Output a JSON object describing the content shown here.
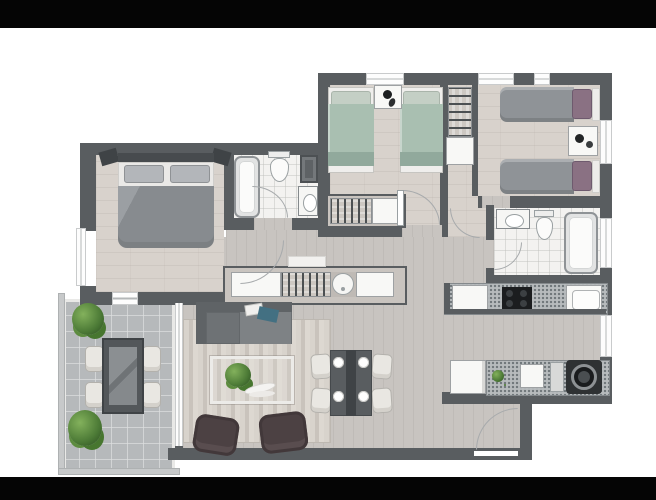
{
  "meta": {
    "description": "Top-down 3D rendered floor plan of a 3-bedroom apartment with two bathrooms, galley kitchen, living-dining room and terrace, shown on a white background with black letterbox bars top and bottom",
    "render_style": "greyscale architectural render"
  },
  "palette": {
    "letterbox": "#050505",
    "wall": "#595d60",
    "floorBed": "#d8d2cc",
    "floorLive": "#c8c4c0",
    "floorBath": "#f3f2f0",
    "floorTerrace": "#b6b9bb",
    "granite": "#b7bbbd",
    "sofa": "#7e8285",
    "chaise": "#6e7275",
    "armchair": "#4c4143",
    "rugA": "#d8d3cc",
    "rugB": "#c9c3bc",
    "bedGreen": "#a9bfb1",
    "bedGreenFold": "#91a99c",
    "pillowGreen": "#c4cfc5",
    "duvetGrey": "#8f9397",
    "pillowPurple": "#8a7183",
    "duvetMaster": "#878b8f",
    "plantDark": "#4c7a36",
    "plantLight": "#83b15c",
    "tableDark": "#595d60",
    "chairCream": "#e9e7e2",
    "accentTeal": "#437082"
  },
  "rooms": {
    "master_bedroom": {
      "label": "Master bedroom",
      "furniture": [
        "double bed with grey duvet",
        "two pillows",
        "headboard",
        "two wall shelves"
      ]
    },
    "bedroom_2": {
      "label": "Bedroom 2",
      "furniture": [
        "single bed left (sage bedding)",
        "single bed right (sage bedding)",
        "nightstand with decor",
        "closet with hanging clothes",
        "white dresser"
      ]
    },
    "bedroom_3": {
      "label": "Bedroom 3",
      "furniture": [
        "single bed top (grey duvet, mauve pillow)",
        "single bed bottom (grey duvet, mauve pillow)",
        "nightstand with carafe",
        "shelf closet with folded clothes"
      ]
    },
    "bathroom_1": {
      "label": "Bathroom 1",
      "furniture": [
        "bathtub",
        "toilet",
        "washbasin vanity",
        "storage shelf"
      ]
    },
    "bathroom_2": {
      "label": "Bathroom 2",
      "furniture": [
        "washbasin vanity",
        "toilet",
        "bathtub"
      ]
    },
    "kitchen": {
      "label": "Kitchen",
      "furniture": [
        "upper counter with cooktop and sink",
        "refrigerator",
        "lower counter with sink and cutting board",
        "washing machine"
      ]
    },
    "living_room": {
      "label": "Living room",
      "furniture": [
        "sofa with chaise",
        "striped rug",
        "coffee table with plant",
        "armchair left",
        "armchair right"
      ]
    },
    "dining_area": {
      "label": "Dining area",
      "furniture": [
        "dining table with runner",
        "four cream chairs",
        "four place settings"
      ]
    },
    "hallway": {
      "label": "Hallway",
      "furniture": [
        "wardrobe row with hanging clothes, laundry basin and cabinet"
      ]
    },
    "terrace": {
      "label": "Terrace",
      "furniture": [
        "outdoor dining table",
        "four outdoor chairs",
        "shrub top",
        "shrub bottom"
      ]
    },
    "entry": {
      "label": "Entry",
      "furniture": [
        "entrance door with swing arc"
      ]
    }
  },
  "openings": {
    "windows": 8,
    "door_arcs": 6,
    "sliding_door": "glass slider between terrace and living room"
  }
}
